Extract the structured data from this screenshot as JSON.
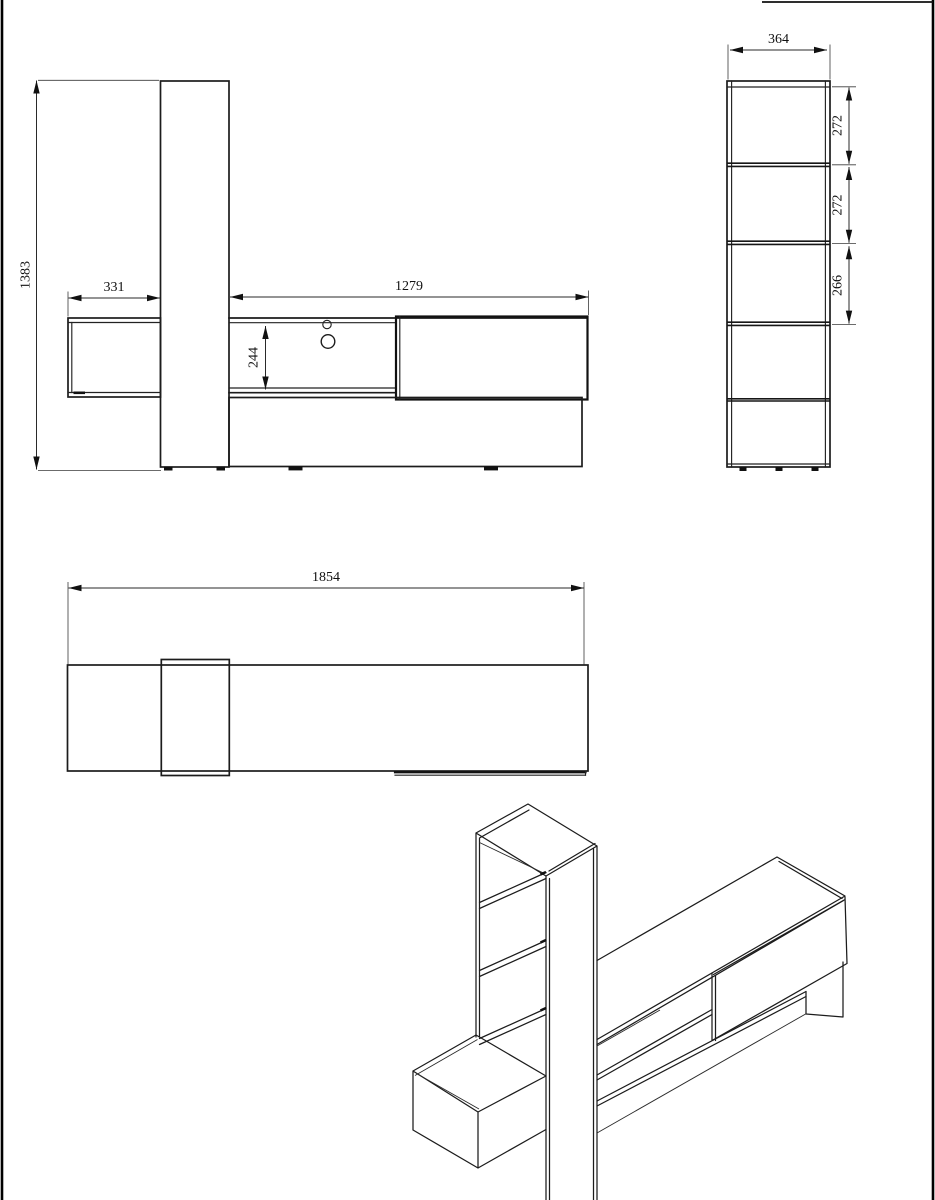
{
  "drawing": {
    "front_view": {
      "total_height": "1383",
      "wall_cabinet_width": "331",
      "tv_bench_width": "1279",
      "niche_height": "244"
    },
    "side_view": {
      "depth": "364",
      "shelf_gap_top": "272",
      "shelf_gap_middle": "272",
      "shelf_gap_bottom": "266"
    },
    "top_view": {
      "total_width": "1854"
    }
  }
}
